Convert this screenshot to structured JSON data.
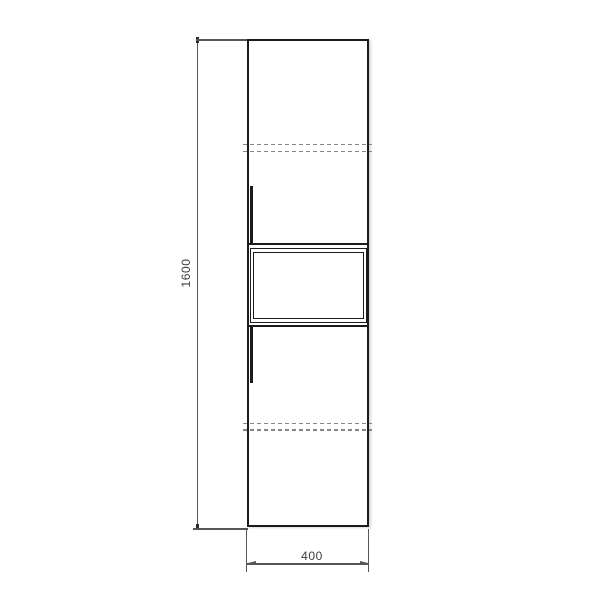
{
  "drawing": {
    "type": "technical-drawing",
    "subject": "tall-cabinet-front-elevation",
    "dimensions": {
      "height_label": "1600",
      "width_label": "400"
    },
    "colors": {
      "background": "#ffffff",
      "outline": "#1b1b1b",
      "dimension": "#55555a",
      "hidden": "#868686",
      "text": "#3b3e49"
    }
  }
}
